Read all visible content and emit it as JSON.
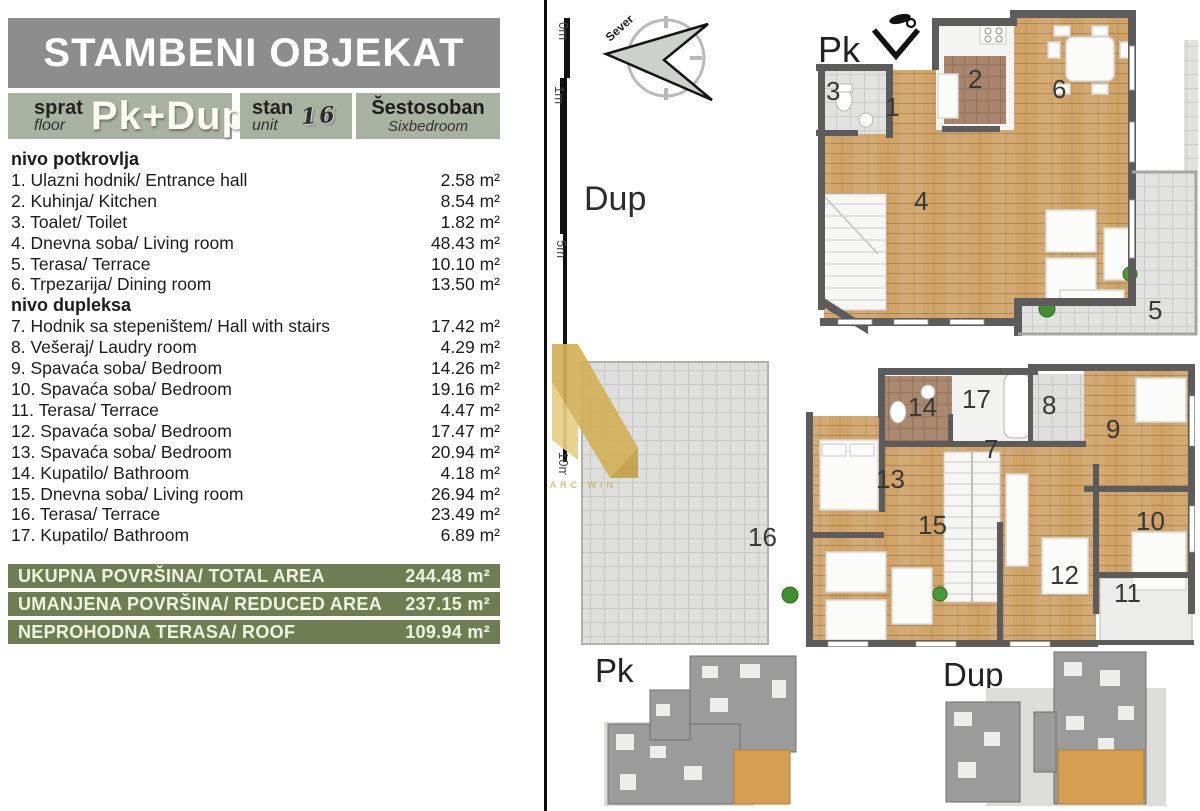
{
  "header": {
    "title": "STAMBENI OBJEKAT"
  },
  "info": {
    "floor_label_sr": "sprat",
    "floor_label_en": "floor",
    "floor_value": "Pk+Dup",
    "unit_label_sr": "stan",
    "unit_label_en": "unit",
    "unit_number": "16",
    "rooms_type_sr": "Šestosoban",
    "rooms_type_en": "Sixbedroom"
  },
  "room_list": {
    "sections": [
      {
        "heading": "nivo potkrovlja",
        "items": [
          {
            "label": "1. Ulazni hodnik/ Entrance hall",
            "area": "2.58 m²"
          },
          {
            "label": "2. Kuhinja/ Kitchen",
            "area": "8.54 m²"
          },
          {
            "label": "3. Toalet/ Toilet",
            "area": "1.82 m²"
          },
          {
            "label": "4. Dnevna soba/ Living room",
            "area": "48.43 m²"
          },
          {
            "label": "5. Terasa/ Terrace",
            "area": "10.10 m²"
          },
          {
            "label": "6. Trpezarija/ Dining room",
            "area": "13.50 m²"
          }
        ]
      },
      {
        "heading": "nivo dupleksa",
        "items": [
          {
            "label": "7. Hodnik sa stepeništem/ Hall with stairs",
            "area": "17.42 m²"
          },
          {
            "label": "8. Vešeraj/ Laudry room",
            "area": "4.29 m²"
          },
          {
            "label": "9. Spavaća soba/ Bedroom",
            "area": "14.26 m²"
          },
          {
            "label": "10. Spavaća soba/ Bedroom",
            "area": "19.16 m²"
          },
          {
            "label": "11. Terasa/ Terrace",
            "area": "4.47 m²"
          },
          {
            "label": "12. Spavaća soba/ Bedroom",
            "area": "17.47 m²"
          },
          {
            "label": "13. Spavaća soba/ Bedroom",
            "area": "20.94 m²"
          },
          {
            "label": "14. Kupatilo/ Bathroom",
            "area": "4.18 m²"
          },
          {
            "label": "15. Dnevna soba/ Living room",
            "area": "26.94 m²"
          },
          {
            "label": "16. Terasa/ Terrace",
            "area": "23.49 m²"
          },
          {
            "label": "17. Kupatilo/ Bathroom",
            "area": "6.89 m²"
          }
        ]
      }
    ]
  },
  "summary": [
    {
      "label": "UKUPNA POVRŠINA/ TOTAL AREA",
      "value": "244.48 m²"
    },
    {
      "label": "UMANJENA POVRŠINA/ REDUCED AREA",
      "value": "237.15 m²"
    },
    {
      "label": "NEPROHODNA TERASA/ ROOF",
      "value": "109.94 m²"
    }
  ],
  "scale_bar": {
    "labels": [
      "0m",
      "1m",
      "5m",
      "10m"
    ]
  },
  "compass": {
    "north_label": "Sever"
  },
  "watermark": {
    "text": "ARCIWIN"
  },
  "plans": {
    "pk": {
      "label": "Pk",
      "room_numbers": [
        "1",
        "2",
        "3",
        "4",
        "5",
        "6"
      ]
    },
    "dup": {
      "label": "Dup",
      "room_numbers": [
        "7",
        "8",
        "9",
        "10",
        "11",
        "12",
        "13",
        "14",
        "15",
        "16",
        "17"
      ]
    },
    "mini": {
      "pk_label": "Pk",
      "dup_label": "Dup"
    }
  },
  "colors": {
    "header_gray": "#8d8d8d",
    "sage": "#a9b1a1",
    "olive": "#6f7e52",
    "wood": "#d0a468",
    "wall": "#5c5c5c",
    "tile": "#e1e1df",
    "unit_highlight": "#d59e52",
    "watermark_gold": "#d6b85e"
  }
}
